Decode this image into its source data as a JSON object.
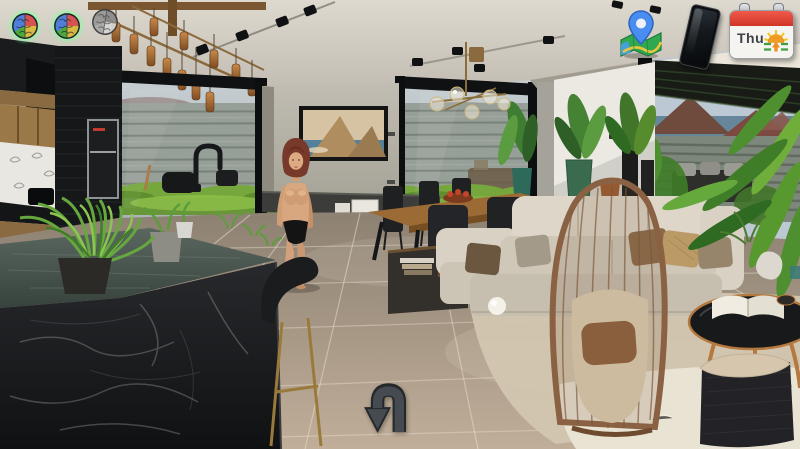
{
  "hud": {
    "mind_icons": [
      {
        "id": "mind-slot-1",
        "state": "active",
        "glow_color": "#5fff82"
      },
      {
        "id": "mind-slot-2",
        "state": "active",
        "glow_color": "#5fff82"
      },
      {
        "id": "mind-slot-3",
        "state": "inactive",
        "glow_color": ""
      }
    ],
    "map_button": {
      "icon": "map-pin",
      "pin_color": "#4a8df0",
      "map_color": "#2fa84f"
    },
    "phone_button": {
      "icon": "smartphone",
      "body_color": "#0b0d10"
    },
    "calendar_widget": {
      "day_label": "Thu",
      "header_color": "#d03527",
      "weather_icon": "sunrise-sun"
    },
    "back_button": {
      "icon": "u-turn-down-arrow",
      "color": "#41474c"
    }
  },
  "scene": {
    "setting": "modern open-plan living room, kitchen island, dining table, sofa, garden view",
    "character": {
      "present": true,
      "hair_color": "#76392a",
      "outfit": "black underwear"
    }
  }
}
